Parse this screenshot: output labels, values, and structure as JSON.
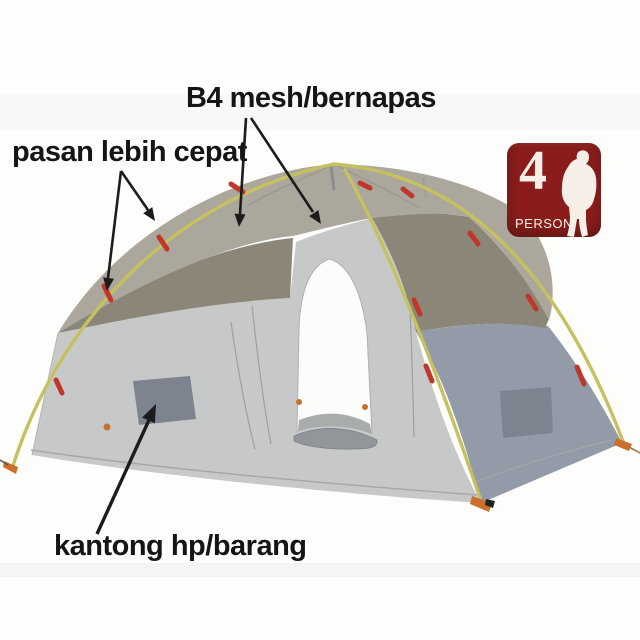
{
  "annotations": {
    "mesh_label": "B4 mesh/bernapas",
    "setup_label": "pasan lebih cepat",
    "pocket_label": "kantong hp/barang"
  },
  "badge": {
    "number": "4",
    "label": "PERSON",
    "icon": "hiker-silhouette"
  },
  "colors": {
    "background": "#fdfdfc",
    "label_text": "#151515",
    "arrow": "#1c1c1c",
    "badge_bg": "#8a1d1b",
    "badge_fg": "#f6efe8",
    "pole": "#c6c160",
    "clip": "#c0372a",
    "rainfly": "#aca79c",
    "mesh_panel": "#8c8678",
    "front_wall": "#c7c9c8",
    "side_wall": "#939ba8",
    "pocket": "#7d838f",
    "floor": "#a9acad",
    "rolled_door": "#92969b",
    "stake": "#c9702f",
    "seam": "#a4a7a6"
  }
}
